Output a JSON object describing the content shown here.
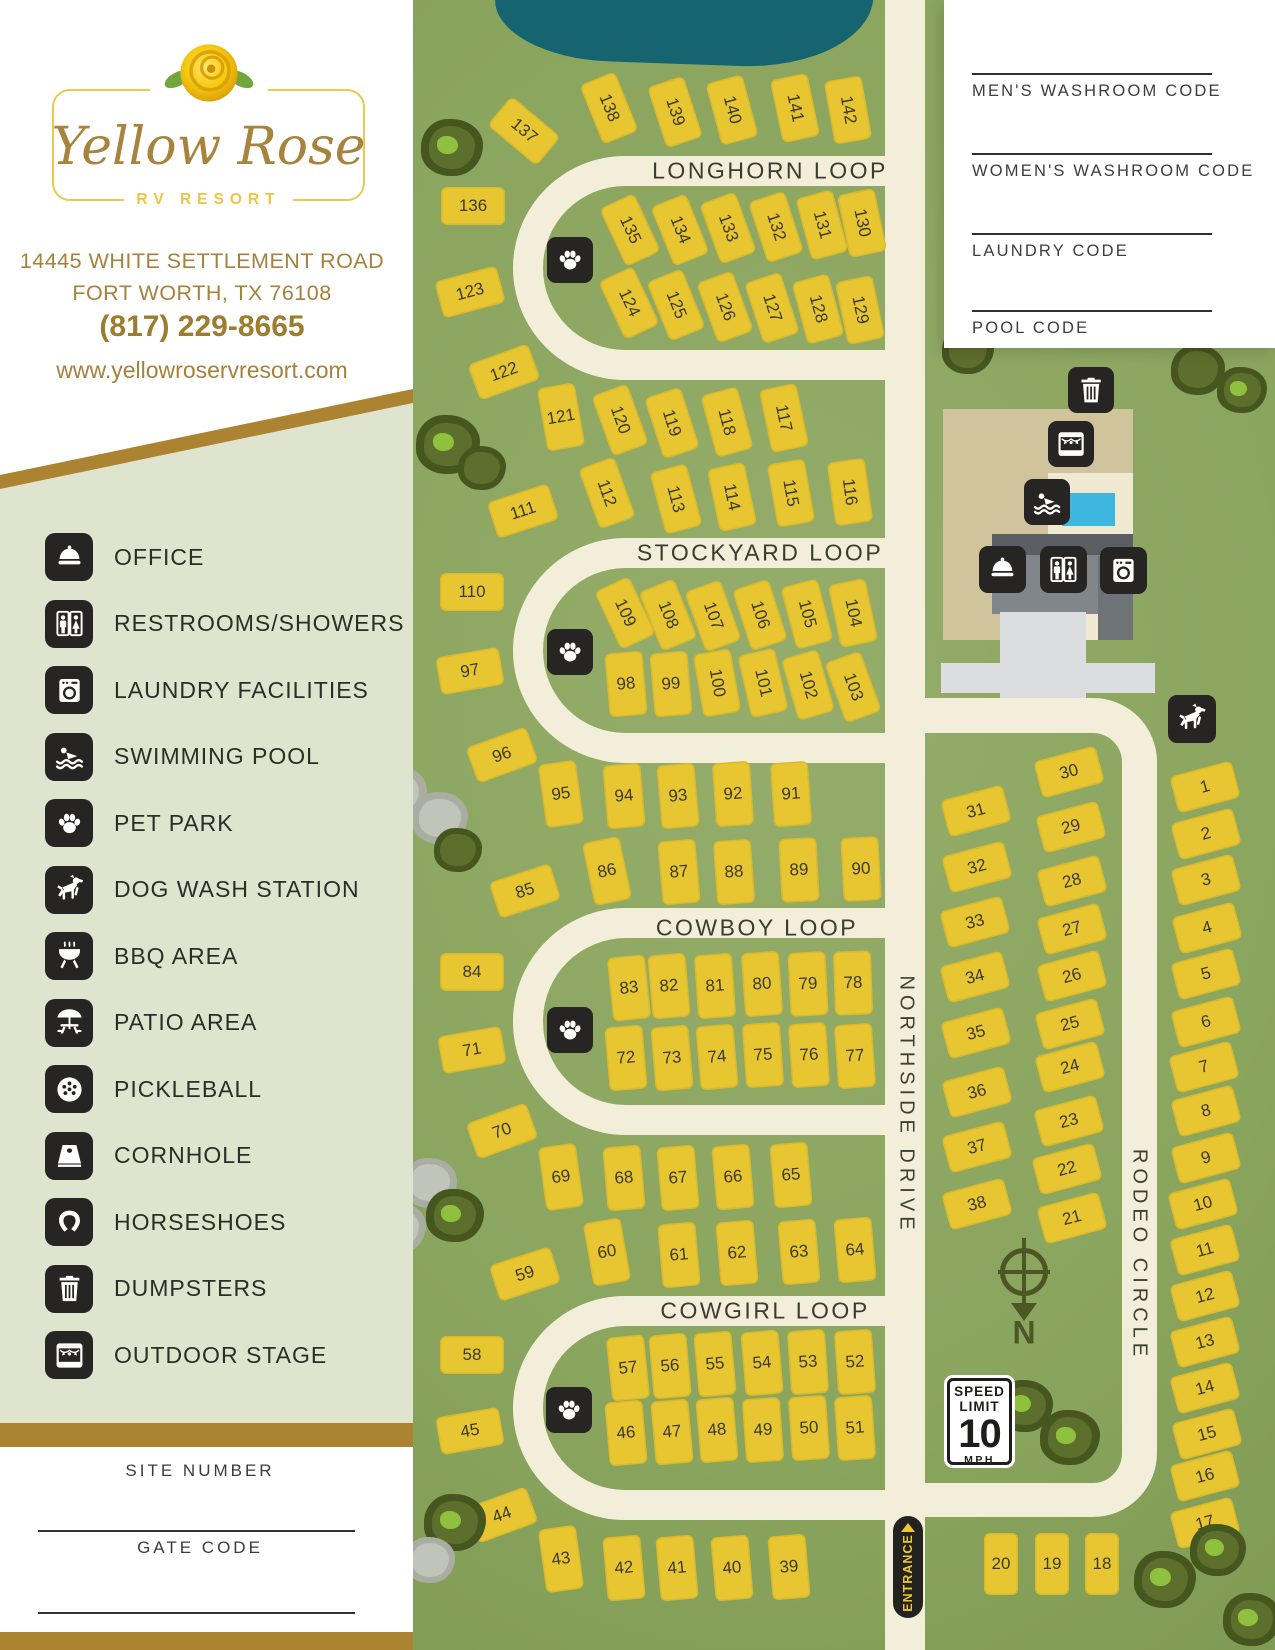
{
  "brand": {
    "script": "Yellow Rose",
    "subtitle": "RV RESORT",
    "address_line1": "14445 WHITE SETTLEMENT ROAD",
    "address_line2": "FORT WORTH, TX 76108",
    "phone": "(817) 229-8665",
    "website": "www.yellowroservresort.com"
  },
  "sidebar": {
    "legend": [
      {
        "icon": "bell",
        "label": "OFFICE"
      },
      {
        "icon": "wc",
        "label": "RESTROOMS/SHOWERS"
      },
      {
        "icon": "laundry",
        "label": "LAUNDRY FACILITIES"
      },
      {
        "icon": "pool",
        "label": "SWIMMING POOL"
      },
      {
        "icon": "paw",
        "label": "PET PARK"
      },
      {
        "icon": "dog",
        "label": "DOG WASH STATION"
      },
      {
        "icon": "bbq",
        "label": "BBQ AREA"
      },
      {
        "icon": "patio",
        "label": "PATIO AREA"
      },
      {
        "icon": "pickle",
        "label": "PICKLEBALL"
      },
      {
        "icon": "cornhole",
        "label": "CORNHOLE"
      },
      {
        "icon": "horseshoe",
        "label": "HORSESHOES"
      },
      {
        "icon": "trash",
        "label": "DUMPSTERS"
      },
      {
        "icon": "stage",
        "label": "OUTDOOR STAGE"
      }
    ],
    "site_number_label": "SITE NUMBER",
    "gate_code_label": "GATE CODE"
  },
  "codes_panel": {
    "fields": [
      "MEN'S WASHROOM CODE",
      "WOMEN'S WASHROOM CODE",
      "LAUNDRY CODE",
      "POOL CODE"
    ],
    "line_y": [
      73,
      153,
      233,
      310
    ]
  },
  "map": {
    "loops": [
      {
        "name": "LONGHORN LOOP",
        "x": 100,
        "y": 156,
        "w": 377,
        "h": 224,
        "lx": 357,
        "ly": 171
      },
      {
        "name": "STOCKYARD LOOP",
        "x": 100,
        "y": 538,
        "w": 377,
        "h": 225,
        "lx": 347,
        "ly": 553
      },
      {
        "name": "COWBOY LOOP",
        "x": 100,
        "y": 908,
        "w": 377,
        "h": 227,
        "lx": 344,
        "ly": 928
      },
      {
        "name": "COWGIRL LOOP",
        "x": 100,
        "y": 1296,
        "w": 377,
        "h": 224,
        "lx": 352,
        "ly": 1311
      }
    ],
    "streets": [
      {
        "name": "NORTHSIDE DRIVE",
        "x": 493,
        "y": 1105
      },
      {
        "name": "RODEO CIRCLE",
        "x": 726,
        "y": 1255
      }
    ],
    "entrance_label": "ENTRANCE",
    "speed_sign": {
      "line1": "SPEED",
      "line2": "LIMIT",
      "value": "10",
      "unit": "MPH"
    },
    "compass_letter": "N",
    "amenities": [
      [
        "paw",
        570,
        260,
        46
      ],
      [
        "paw",
        570,
        652,
        46
      ],
      [
        "paw",
        570,
        1030,
        46
      ],
      [
        "paw",
        569,
        1410,
        46
      ],
      [
        "trash",
        1091,
        390,
        46
      ],
      [
        "stage",
        1071,
        444,
        46
      ],
      [
        "pool",
        1047,
        502,
        46
      ],
      [
        "bell",
        1002,
        569,
        47
      ],
      [
        "wc",
        1063,
        569,
        47
      ],
      [
        "laundry",
        1123,
        570,
        47
      ],
      [
        "dog",
        1192,
        719,
        48
      ]
    ],
    "trees": [
      [
        452,
        150,
        62,
        "d",
        1
      ],
      [
        448,
        447,
        64,
        "d",
        1
      ],
      [
        482,
        470,
        48,
        "d",
        0
      ],
      [
        440,
        820,
        56,
        "g",
        0
      ],
      [
        458,
        852,
        48,
        "d",
        0
      ],
      [
        430,
        1185,
        54,
        "g",
        0
      ],
      [
        455,
        1218,
        58,
        "d",
        1
      ],
      [
        455,
        1525,
        62,
        "d",
        1
      ],
      [
        430,
        1562,
        50,
        "g",
        0
      ],
      [
        968,
        352,
        52,
        "d",
        0
      ],
      [
        1198,
        372,
        54,
        "d",
        0
      ],
      [
        1242,
        392,
        50,
        "d",
        1
      ],
      [
        1025,
        1408,
        56,
        "d",
        1
      ],
      [
        1070,
        1440,
        60,
        "d",
        1
      ],
      [
        1165,
        1582,
        62,
        "d",
        1
      ],
      [
        1218,
        1552,
        56,
        "d",
        1
      ],
      [
        1252,
        1622,
        58,
        "d",
        1
      ],
      [
        398,
        795,
        58,
        "g",
        1
      ],
      [
        372,
        1085,
        62,
        "g",
        1
      ],
      [
        398,
        1230,
        56,
        "g",
        0
      ],
      [
        70,
        1300,
        60,
        "g",
        1
      ],
      [
        340,
        1140,
        48,
        "g",
        0
      ]
    ],
    "sites": [
      [
        "137",
        524,
        131,
        -50,
        "t",
        "a"
      ],
      [
        "138",
        609,
        108,
        -22,
        "t",
        "a"
      ],
      [
        "139",
        675,
        112,
        -18,
        "t",
        "a"
      ],
      [
        "140",
        732,
        110,
        -15,
        "t",
        "a"
      ],
      [
        "141",
        795,
        108,
        -12,
        "t",
        "a"
      ],
      [
        "142",
        848,
        110,
        -10,
        "t",
        "a"
      ],
      [
        "136",
        473,
        206,
        0,
        "w",
        "w"
      ],
      [
        "123",
        470,
        292,
        -15,
        "w",
        "w"
      ],
      [
        "135",
        630,
        230,
        -25,
        "t",
        "a"
      ],
      [
        "134",
        680,
        230,
        -22,
        "t",
        "a"
      ],
      [
        "133",
        728,
        228,
        -20,
        "t",
        "a"
      ],
      [
        "132",
        776,
        227,
        -18,
        "t",
        "a"
      ],
      [
        "131",
        822,
        225,
        -15,
        "t",
        "a"
      ],
      [
        "130",
        862,
        223,
        -12,
        "t",
        "a"
      ],
      [
        "124",
        629,
        303,
        -25,
        "t",
        "a"
      ],
      [
        "125",
        676,
        305,
        -22,
        "t",
        "a"
      ],
      [
        "126",
        725,
        307,
        -20,
        "t",
        "a"
      ],
      [
        "127",
        772,
        308,
        -18,
        "t",
        "a"
      ],
      [
        "128",
        818,
        309,
        -15,
        "t",
        "a"
      ],
      [
        "129",
        860,
        310,
        -12,
        "t",
        "a"
      ],
      [
        "122",
        504,
        372,
        -20,
        "w",
        "w"
      ],
      [
        "121",
        561,
        417,
        -10,
        "t",
        "w"
      ],
      [
        "120",
        620,
        420,
        -20,
        "t",
        "a"
      ],
      [
        "119",
        672,
        423,
        -18,
        "t",
        "a"
      ],
      [
        "118",
        727,
        422,
        -15,
        "t",
        "a"
      ],
      [
        "117",
        784,
        418,
        -12,
        "t",
        "a"
      ],
      [
        "112",
        607,
        493,
        -20,
        "t",
        "a"
      ],
      [
        "113",
        676,
        499,
        -15,
        "t",
        "a"
      ],
      [
        "114",
        732,
        497,
        -12,
        "t",
        "a"
      ],
      [
        "115",
        791,
        493,
        -10,
        "t",
        "a"
      ],
      [
        "116",
        850,
        492,
        -8,
        "t",
        "a"
      ],
      [
        "111",
        523,
        511,
        -18,
        "w",
        "w"
      ],
      [
        "110",
        472,
        592,
        0,
        "w",
        "w"
      ],
      [
        "97",
        470,
        671,
        -10,
        "w",
        "w"
      ],
      [
        "109",
        625,
        613,
        -25,
        "t",
        "a"
      ],
      [
        "108",
        668,
        615,
        -22,
        "t",
        "a"
      ],
      [
        "107",
        713,
        616,
        -20,
        "t",
        "a"
      ],
      [
        "106",
        760,
        615,
        -18,
        "t",
        "a"
      ],
      [
        "105",
        807,
        614,
        -15,
        "t",
        "a"
      ],
      [
        "104",
        853,
        613,
        -12,
        "t",
        "a"
      ],
      [
        "98",
        626,
        684,
        -5,
        "t",
        "w"
      ],
      [
        "99",
        671,
        684,
        -5,
        "t",
        "w"
      ],
      [
        "100",
        717,
        683,
        -10,
        "t",
        "a"
      ],
      [
        "101",
        763,
        683,
        -13,
        "t",
        "a"
      ],
      [
        "102",
        808,
        685,
        -16,
        "t",
        "a"
      ],
      [
        "103",
        853,
        687,
        -20,
        "t",
        "a"
      ],
      [
        "96",
        502,
        755,
        -20,
        "w",
        "w"
      ],
      [
        "95",
        561,
        794,
        -8,
        "t",
        "w"
      ],
      [
        "94",
        624,
        796,
        -5,
        "t",
        "w"
      ],
      [
        "93",
        678,
        796,
        -5,
        "t",
        "w"
      ],
      [
        "92",
        733,
        794,
        -4,
        "t",
        "w"
      ],
      [
        "91",
        791,
        794,
        -4,
        "t",
        "w"
      ],
      [
        "86",
        607,
        871,
        -12,
        "t",
        "w"
      ],
      [
        "87",
        679,
        872,
        -5,
        "t",
        "w"
      ],
      [
        "88",
        734,
        872,
        -4,
        "t",
        "w"
      ],
      [
        "89",
        799,
        870,
        -3,
        "t",
        "w"
      ],
      [
        "90",
        861,
        869,
        -3,
        "t",
        "w"
      ],
      [
        "85",
        525,
        891,
        -18,
        "w",
        "w"
      ],
      [
        "84",
        472,
        972,
        0,
        "w",
        "w"
      ],
      [
        "71",
        472,
        1050,
        -10,
        "w",
        "w"
      ],
      [
        "83",
        629,
        988,
        -6,
        "t",
        "w"
      ],
      [
        "82",
        669,
        986,
        -5,
        "t",
        "w"
      ],
      [
        "81",
        715,
        986,
        -4,
        "t",
        "w"
      ],
      [
        "80",
        762,
        984,
        -4,
        "t",
        "w"
      ],
      [
        "79",
        808,
        984,
        -3,
        "t",
        "w"
      ],
      [
        "78",
        853,
        983,
        -2,
        "t",
        "w"
      ],
      [
        "72",
        626,
        1058,
        -5,
        "t",
        "w"
      ],
      [
        "73",
        672,
        1058,
        -5,
        "t",
        "w"
      ],
      [
        "74",
        717,
        1057,
        -5,
        "t",
        "w"
      ],
      [
        "75",
        763,
        1055,
        -4,
        "t",
        "w"
      ],
      [
        "76",
        809,
        1055,
        -4,
        "t",
        "w"
      ],
      [
        "77",
        855,
        1056,
        -4,
        "t",
        "w"
      ],
      [
        "70",
        502,
        1131,
        -20,
        "w",
        "w"
      ],
      [
        "69",
        561,
        1177,
        -8,
        "t",
        "w"
      ],
      [
        "68",
        624,
        1178,
        -5,
        "t",
        "w"
      ],
      [
        "67",
        678,
        1178,
        -5,
        "t",
        "w"
      ],
      [
        "66",
        733,
        1177,
        -5,
        "t",
        "w"
      ],
      [
        "65",
        791,
        1175,
        -5,
        "t",
        "w"
      ],
      [
        "60",
        607,
        1252,
        -10,
        "t",
        "w"
      ],
      [
        "61",
        679,
        1255,
        -5,
        "t",
        "w"
      ],
      [
        "62",
        737,
        1253,
        -5,
        "t",
        "w"
      ],
      [
        "63",
        799,
        1252,
        -5,
        "t",
        "w"
      ],
      [
        "64",
        855,
        1250,
        -5,
        "t",
        "w"
      ],
      [
        "59",
        525,
        1274,
        -18,
        "w",
        "w"
      ],
      [
        "58",
        472,
        1355,
        0,
        "w",
        "w"
      ],
      [
        "45",
        470,
        1431,
        -10,
        "w",
        "w"
      ],
      [
        "57",
        628,
        1368,
        -6,
        "t",
        "w"
      ],
      [
        "56",
        670,
        1366,
        -5,
        "t",
        "w"
      ],
      [
        "55",
        715,
        1364,
        -5,
        "t",
        "w"
      ],
      [
        "54",
        762,
        1363,
        -5,
        "t",
        "w"
      ],
      [
        "53",
        808,
        1362,
        -4,
        "t",
        "w"
      ],
      [
        "52",
        855,
        1362,
        -4,
        "t",
        "w"
      ],
      [
        "46",
        626,
        1433,
        -5,
        "t",
        "w"
      ],
      [
        "47",
        672,
        1432,
        -5,
        "t",
        "w"
      ],
      [
        "48",
        717,
        1430,
        -5,
        "t",
        "w"
      ],
      [
        "49",
        763,
        1430,
        -4,
        "t",
        "w"
      ],
      [
        "50",
        809,
        1428,
        -4,
        "t",
        "w"
      ],
      [
        "51",
        855,
        1428,
        -4,
        "t",
        "w"
      ],
      [
        "44",
        502,
        1515,
        -20,
        "w",
        "w"
      ],
      [
        "43",
        561,
        1559,
        -8,
        "t",
        "w"
      ],
      [
        "42",
        624,
        1568,
        -5,
        "t",
        "w"
      ],
      [
        "41",
        677,
        1568,
        -5,
        "t",
        "w"
      ],
      [
        "40",
        732,
        1568,
        -5,
        "t",
        "w"
      ],
      [
        "39",
        789,
        1567,
        -5,
        "t",
        "w"
      ],
      [
        "31",
        976,
        811,
        -15,
        "w",
        "w"
      ],
      [
        "32",
        977,
        867,
        -15,
        "w",
        "w"
      ],
      [
        "33",
        975,
        922,
        -15,
        "w",
        "w"
      ],
      [
        "34",
        975,
        977,
        -15,
        "w",
        "w"
      ],
      [
        "35",
        976,
        1033,
        -15,
        "w",
        "w"
      ],
      [
        "36",
        977,
        1092,
        -15,
        "w",
        "w"
      ],
      [
        "37",
        977,
        1147,
        -15,
        "w",
        "w"
      ],
      [
        "38",
        977,
        1204,
        -15,
        "w",
        "w"
      ],
      [
        "30",
        1069,
        772,
        -15,
        "w",
        "w"
      ],
      [
        "29",
        1071,
        827,
        -15,
        "w",
        "w"
      ],
      [
        "28",
        1072,
        881,
        -15,
        "w",
        "w"
      ],
      [
        "27",
        1072,
        929,
        -15,
        "w",
        "w"
      ],
      [
        "26",
        1072,
        976,
        -15,
        "w",
        "w"
      ],
      [
        "25",
        1070,
        1024,
        -15,
        "w",
        "w"
      ],
      [
        "24",
        1070,
        1067,
        -15,
        "w",
        "w"
      ],
      [
        "23",
        1069,
        1121,
        -15,
        "w",
        "w"
      ],
      [
        "22",
        1067,
        1169,
        -15,
        "w",
        "w"
      ],
      [
        "21",
        1072,
        1218,
        -15,
        "w",
        "w"
      ],
      [
        "1",
        1205,
        787,
        -15,
        "w",
        "w"
      ],
      [
        "2",
        1206,
        834,
        -15,
        "w",
        "w"
      ],
      [
        "3",
        1206,
        880,
        -15,
        "w",
        "w"
      ],
      [
        "4",
        1207,
        928,
        -15,
        "w",
        "w"
      ],
      [
        "5",
        1206,
        974,
        -15,
        "w",
        "w"
      ],
      [
        "6",
        1206,
        1022,
        -15,
        "w",
        "w"
      ],
      [
        "7",
        1204,
        1067,
        -15,
        "w",
        "w"
      ],
      [
        "8",
        1206,
        1111,
        -15,
        "w",
        "w"
      ],
      [
        "9",
        1206,
        1158,
        -15,
        "w",
        "w"
      ],
      [
        "10",
        1203,
        1204,
        -15,
        "w",
        "w"
      ],
      [
        "11",
        1205,
        1250,
        -15,
        "w",
        "w"
      ],
      [
        "12",
        1205,
        1296,
        -15,
        "w",
        "w"
      ],
      [
        "13",
        1205,
        1342,
        -15,
        "w",
        "w"
      ],
      [
        "14",
        1205,
        1388,
        -15,
        "w",
        "w"
      ],
      [
        "15",
        1207,
        1434,
        -15,
        "w",
        "w"
      ],
      [
        "16",
        1205,
        1476,
        -15,
        "w",
        "w"
      ],
      [
        "17",
        1205,
        1523,
        -15,
        "w",
        "w"
      ],
      [
        "20",
        1001,
        1564,
        0,
        "u",
        "h"
      ],
      [
        "19",
        1052,
        1564,
        0,
        "u",
        "h"
      ],
      [
        "18",
        1102,
        1564,
        0,
        "u",
        "h"
      ]
    ],
    "colors": {
      "map_green": "#8aa55e",
      "road_cream": "#f2eed9",
      "site_yellow": "#e8c632",
      "pond_teal": "#15646f",
      "sage": "#dee4ce",
      "gold": "#ac8331",
      "icon_tile": "#262523",
      "pool_blue": "#3db7e0"
    }
  }
}
